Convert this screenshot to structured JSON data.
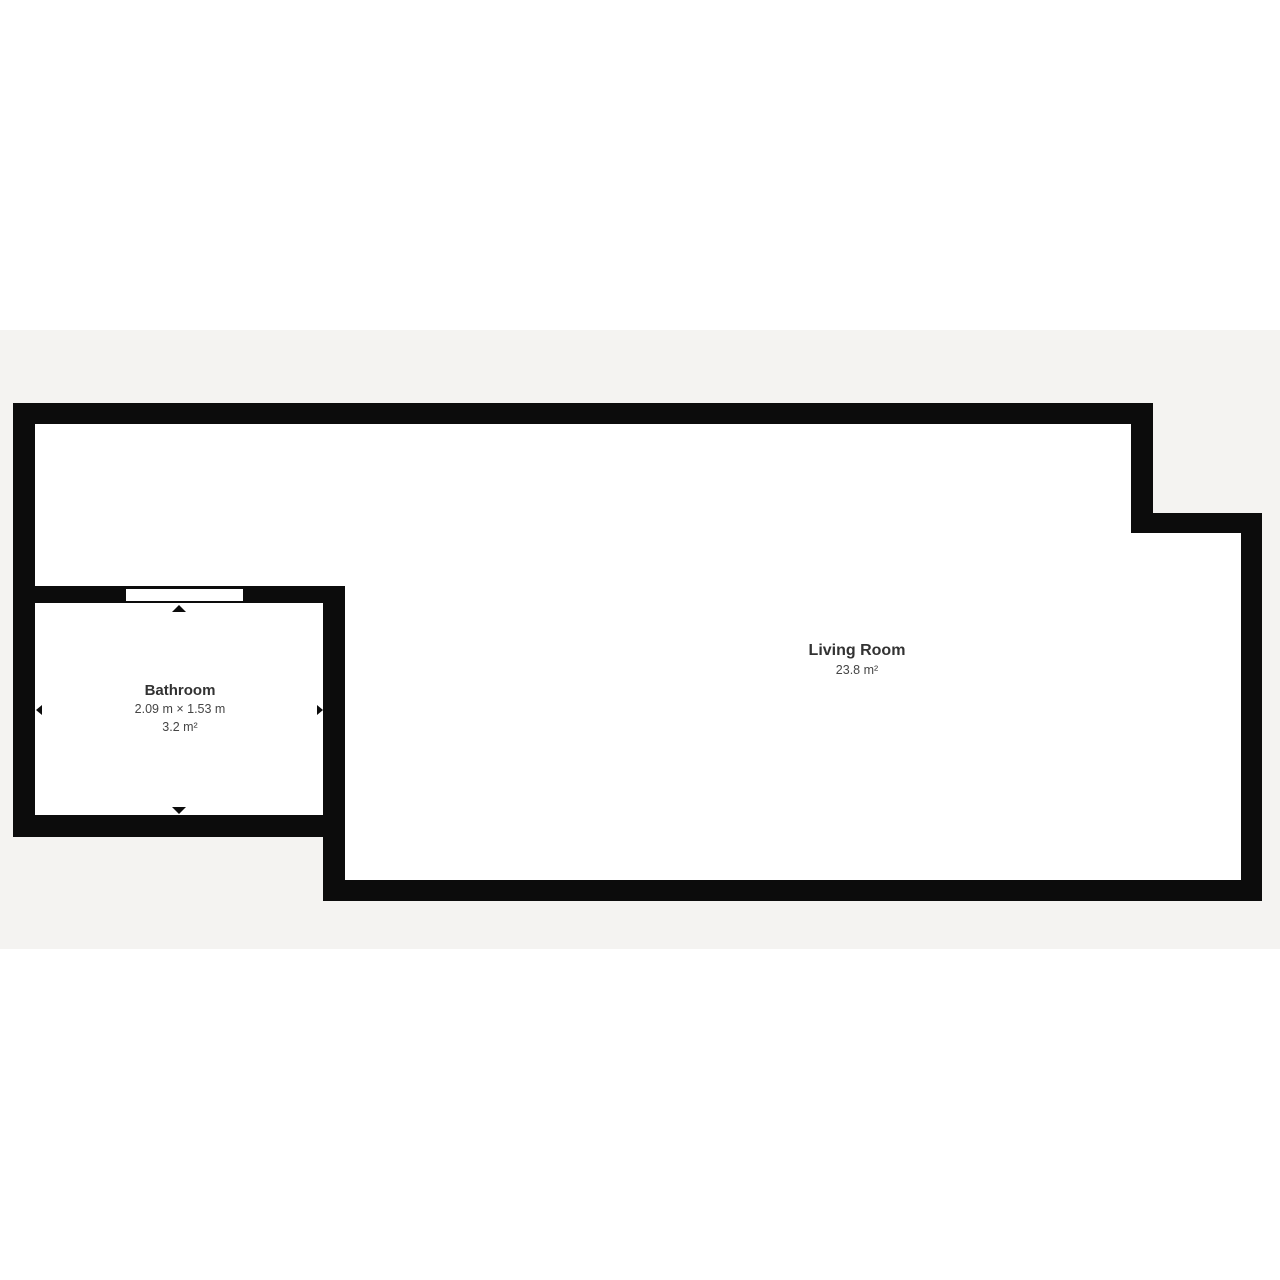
{
  "page": {
    "background_color": "#ffffff",
    "canvas_band_color": "#f4f3f1"
  },
  "floorplan": {
    "wall_color": "#0c0c0c",
    "rooms": [
      {
        "name": "Bathroom",
        "dimensions": "2.09 m × 1.53 m",
        "area": "3.2 m²"
      },
      {
        "name": "Living Room",
        "area": "23.8 m²"
      }
    ],
    "features": {
      "window_count": 1,
      "dimension_arrows": [
        "up",
        "down",
        "left",
        "right"
      ]
    }
  }
}
